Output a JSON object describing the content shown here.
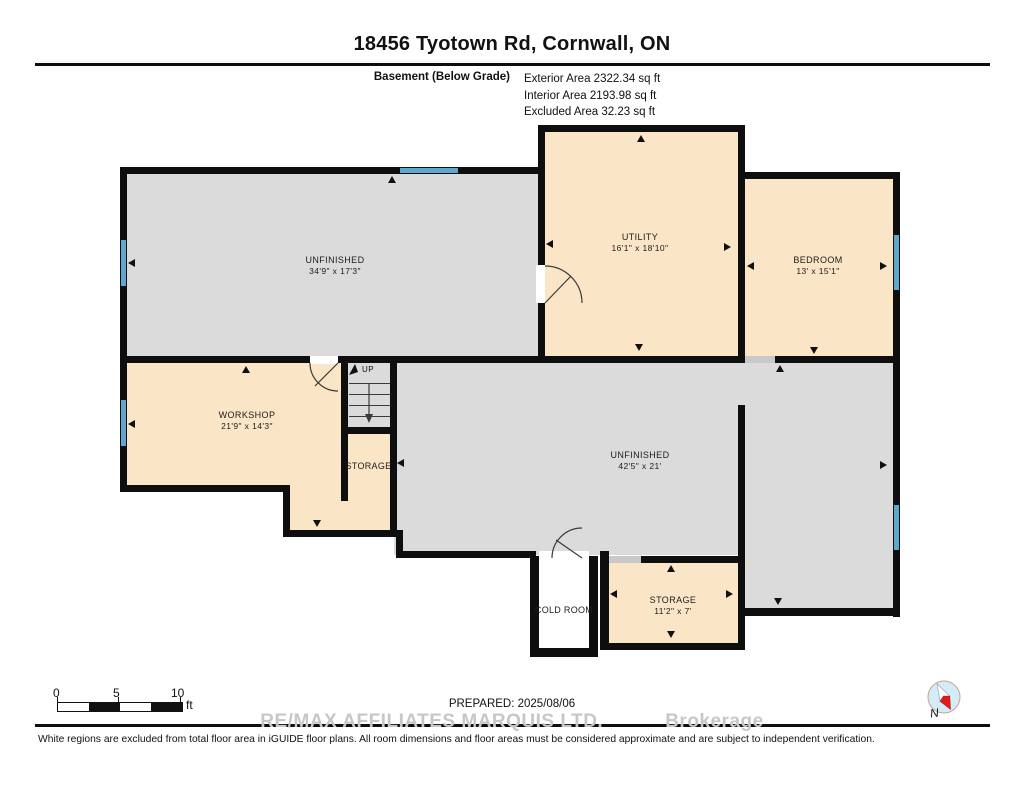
{
  "header": {
    "title": "18456 Tyotown Rd, Cornwall, ON",
    "floor_label": "Basement (Below Grade)",
    "areas": [
      "Exterior Area 2322.34 sq ft",
      "Interior Area 2193.98 sq ft",
      "Excluded Area 32.23 sq ft"
    ]
  },
  "rooms": {
    "unfinished_upper": {
      "name": "UNFINISHED",
      "dims": "34'9\" x 17'3\""
    },
    "utility": {
      "name": "UTILITY",
      "dims": "16'1\" x 18'10\""
    },
    "bedroom": {
      "name": "BEDROOM",
      "dims": "13' x 15'1\""
    },
    "workshop": {
      "name": "WORKSHOP",
      "dims": "21'9\" x 14'3\""
    },
    "storage_upper": {
      "name": "STORAGE"
    },
    "unfinished_lower": {
      "name": "UNFINISHED",
      "dims": "42'5\" x 21'"
    },
    "cold_room": {
      "name": "COLD ROOM"
    },
    "storage_lower": {
      "name": "STORAGE",
      "dims": "11'2\" x 7'"
    }
  },
  "stairs": {
    "label": "UP"
  },
  "scale_bar": {
    "ticks": [
      "0",
      "5",
      "10"
    ],
    "unit": "ft"
  },
  "compass": {
    "label": "N"
  },
  "footer": {
    "prepared": "PREPARED: 2025/08/06",
    "watermark_line1": "RE/MAX AFFILIATES MARQUIS LTD.",
    "watermark_line2": "Brokerage",
    "disclaimer": "White regions are excluded from total floor area in iGUIDE floor plans. All room dimensions and floor areas must be considered approximate and are subject to independent verification."
  },
  "icons": {
    "compass": "compass-icon",
    "dimension_arrow": "dimension-arrow-icon",
    "window": "window-marker",
    "door": "door-arc"
  },
  "colors": {
    "wall": "#0e0e0e",
    "room_gray": "#dbdbdb",
    "room_tan": "#fae5c6",
    "window_blue": "#5ea7cf",
    "opening_gray": "#c9c9c9",
    "watermark_gray": "#c7c7c7",
    "compass_red": "#e01b1b"
  }
}
